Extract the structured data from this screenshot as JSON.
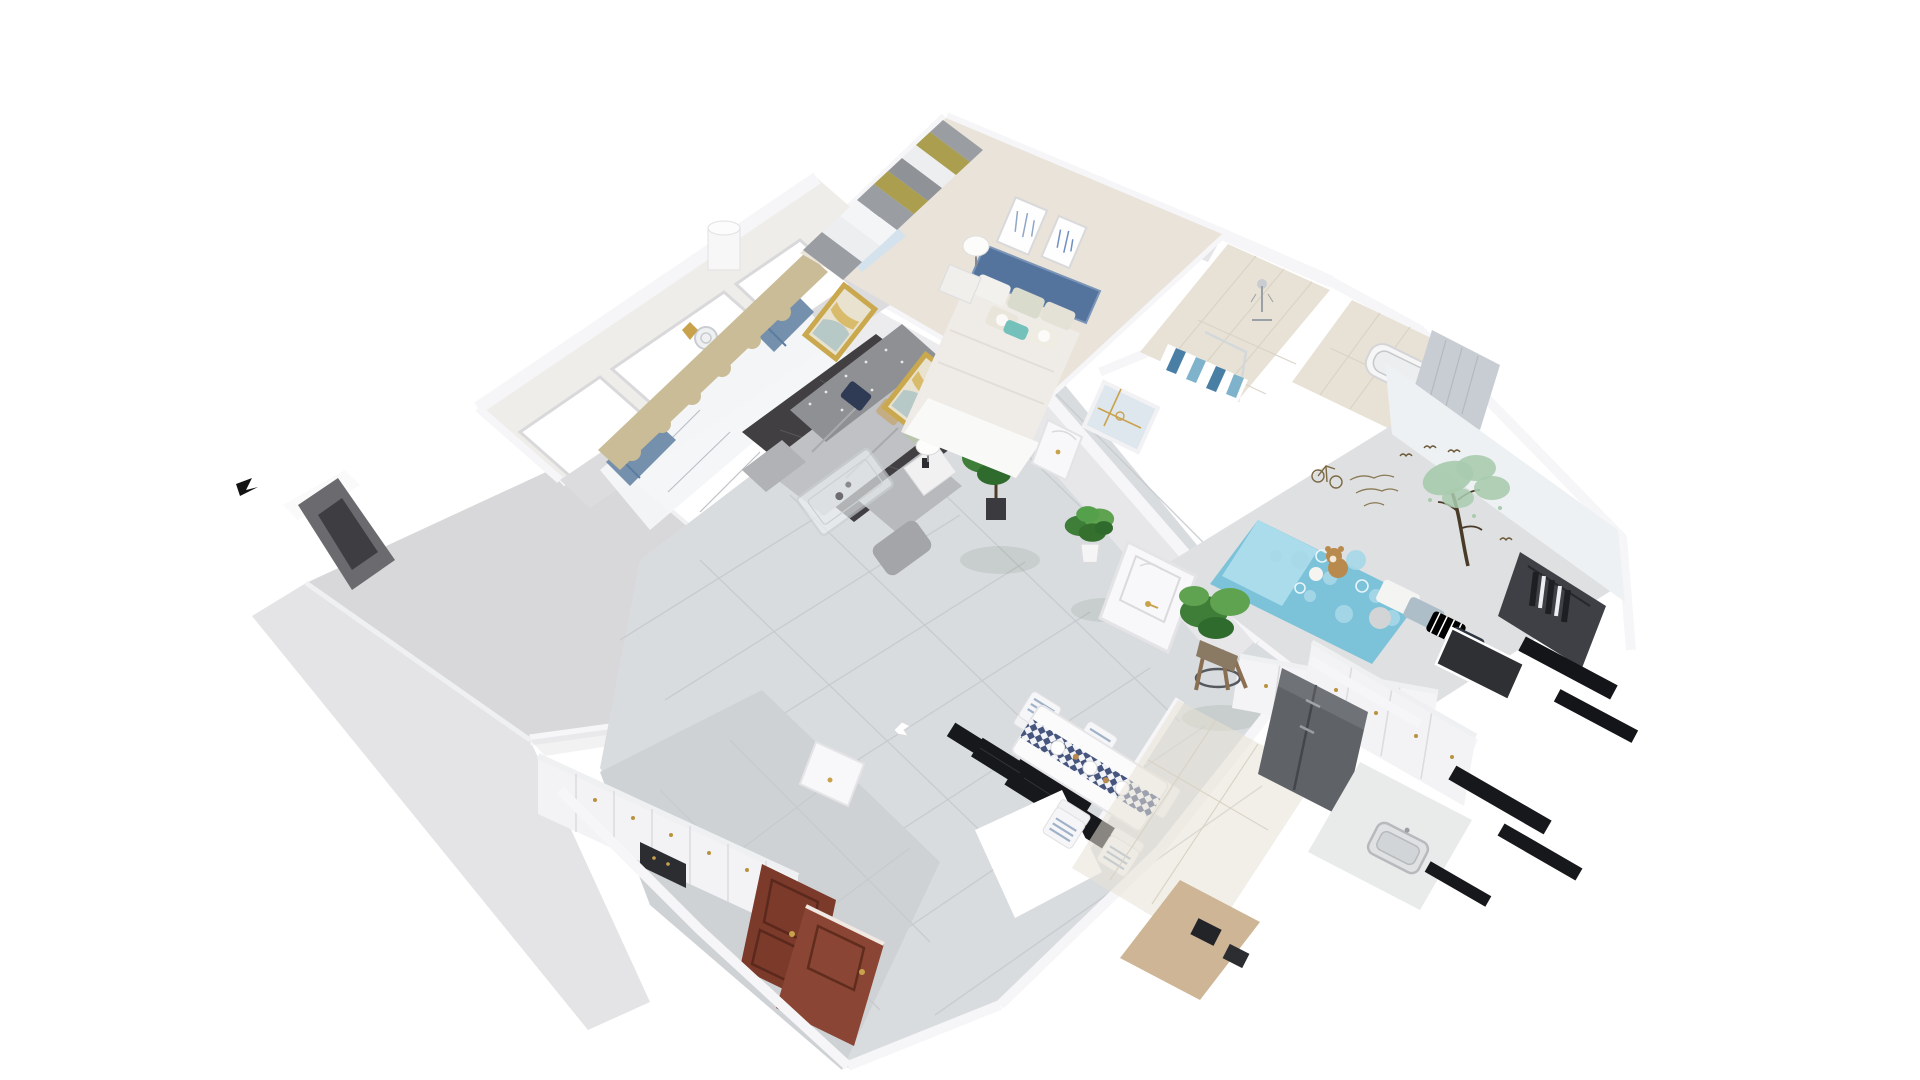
{
  "scene": {
    "type": "3d-floorplan-dollhouse-render",
    "title": "Isometric cutaway render of a furnished two-bedroom apartment",
    "view": "aerial oblique, white background",
    "rooms": [
      {
        "id": "balcony",
        "label": "balcony with triple window wall"
      },
      {
        "id": "living-room",
        "label": "living room: gray sectional sofa, dark rug, glass coffee table, gold-teal artworks, tan valance with blue curtains"
      },
      {
        "id": "master-bedroom",
        "label": "master bedroom: blue upholstered bed, white table lamp, two framed prints, gray-olive striped curtains"
      },
      {
        "id": "shower-bathroom",
        "label": "bathroom with shower and blue striped accent tile"
      },
      {
        "id": "tub-bathroom",
        "label": "second bathroom with tub and gray drape"
      },
      {
        "id": "kids-bedroom",
        "label": "kids bedroom: blue polka-dot bed, teddy bear, tree wall decal, white wardrobe, dark closet"
      },
      {
        "id": "hallway",
        "label": "hallway with glossy marble tile and potted plants"
      },
      {
        "id": "dining-area",
        "label": "dining table with checkered runner, white chairs, black wall panels"
      },
      {
        "id": "kitchen",
        "label": "kitchen: white cabinets, gray fridge, counter with sink"
      },
      {
        "id": "entry",
        "label": "entry: white shoe cabinets with gold knobs, mahogany front doors"
      },
      {
        "id": "covered-room",
        "label": "room hidden under flat gray roof slab"
      }
    ]
  },
  "palette": {
    "background": "#ffffff",
    "slab": "#d8d8da",
    "exterior": "#e4e4e6",
    "wall_face": "#ececee",
    "wall_gray": "#e7e7ea",
    "marble": "#d9dcdf",
    "entry_tile": "#cfd2d5",
    "tile_beige": "#e8e2d6",
    "rug": "#413f42",
    "sofa": "#bfc1c4",
    "sofa_back": "#8e9094",
    "valance": "#c9bc97",
    "curtain_blue": "#7590ac",
    "sheer": "#f4f6f8",
    "bedroom_floor": "#e9e3da",
    "headboard": "#54749e",
    "duvet": "#efece7",
    "pillow_teal": "#74c1bb",
    "kids_wall": "#eef1f3",
    "kids_bed": "#7cc2d9",
    "kids_bed_light": "#aadcec",
    "wardrobe": "#f4f4f6",
    "wardrobe_dark": "#3f4045",
    "black_panel": "#17181b",
    "fridge": "#5f6267",
    "cabinet": "#f3f3f5",
    "counter": "#e9eaea",
    "wood_counter": "#cdb595",
    "door_wood": "#7b3a2a",
    "door_wood_open": "#8a4534",
    "white_door": "#f8f8fa",
    "frosted_glass": "#dfe7ee",
    "plant": "#3e7e39",
    "plant_light": "#5fa24f",
    "pot_dark": "#3b3b3f",
    "gold": "#c9a24c",
    "art_frame_gold": "#caa94e",
    "art_teal": "#b7c9c6",
    "art_gold": "#d9bc6b",
    "runner_navy": "#46557e",
    "runner_white": "#f2f3f6",
    "stripe_blue": "#4a7fa5",
    "stripe_teal": "#7fb3cc",
    "drape_dark": "#6b6b6f",
    "teddy": "#b98a4e",
    "decal_green": "#a9cbae",
    "decal_brown": "#6b5836",
    "curtain_gray": "#9a9da2",
    "curtain_olive": "#ab9e4e"
  }
}
